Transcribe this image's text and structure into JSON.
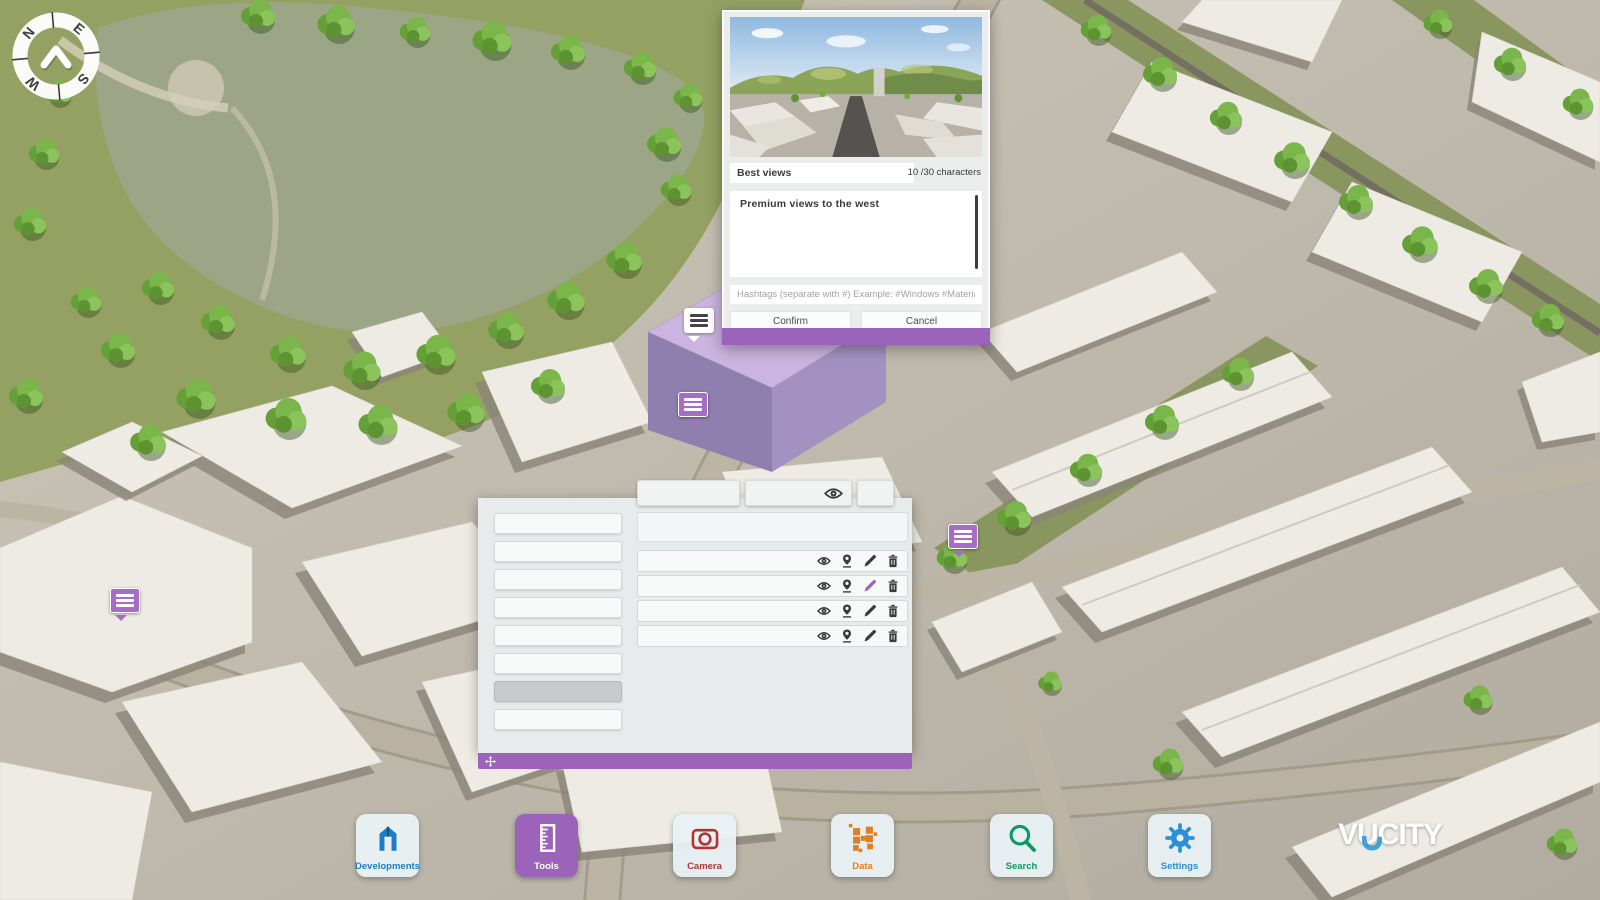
{
  "logo": {
    "text": "VUCITY"
  },
  "compass": {
    "letters": [
      "N",
      "E",
      "S",
      "W"
    ]
  },
  "map": {
    "markers": [
      {
        "id": "note-marker-1",
        "style": "white",
        "x": 684,
        "y": 308
      },
      {
        "id": "note-marker-2",
        "style": "purple",
        "x": 678,
        "y": 392
      },
      {
        "id": "note-marker-3",
        "style": "purple",
        "x": 948,
        "y": 524
      },
      {
        "id": "note-marker-4",
        "style": "purple",
        "x": 110,
        "y": 588
      }
    ],
    "selected_development_color": "#ccb4e0"
  },
  "annotation_dialog": {
    "title_value": "Best views",
    "char_counter": "10 /30 characters",
    "description_value": "Premium views to the west",
    "hashtags_placeholder": "Hashtags (separate with #) Example: #Windows #Material",
    "confirm_label": "Confirm",
    "cancel_label": "Cancel"
  },
  "tools_panel": {
    "header_buttons": [
      {
        "label": "",
        "icon": null
      },
      {
        "label": "",
        "icon": "eye-icon"
      },
      {
        "label": "",
        "icon": null
      }
    ],
    "left_buttons": {
      "count": 8,
      "selected_index": 6
    },
    "note_title_field_value": "",
    "note_rows": [
      {
        "icons": [
          "eye",
          "location-pin",
          "edit-pencil",
          "delete-trash"
        ],
        "edit_active": false
      },
      {
        "icons": [
          "eye",
          "location-pin",
          "edit-pencil",
          "delete-trash"
        ],
        "edit_active": true
      },
      {
        "icons": [
          "eye",
          "location-pin",
          "edit-pencil",
          "delete-trash"
        ],
        "edit_active": false
      },
      {
        "icons": [
          "eye",
          "location-pin",
          "edit-pencil",
          "delete-trash"
        ],
        "edit_active": false
      }
    ]
  },
  "toolbar": {
    "items": [
      {
        "id": "developments",
        "label": "Developments",
        "color": "#1d7dc4",
        "active": false
      },
      {
        "id": "tools",
        "label": "Tools",
        "color": "#9b63b9",
        "active": true
      },
      {
        "id": "camera",
        "label": "Camera",
        "color": "#b13434",
        "active": false
      },
      {
        "id": "data",
        "label": "Data",
        "color": "#e07f1f",
        "active": false
      },
      {
        "id": "search",
        "label": "Search",
        "color": "#0d9862",
        "active": false
      },
      {
        "id": "settings",
        "label": "Settings",
        "color": "#2b8fd8",
        "active": false
      }
    ]
  },
  "colors": {
    "accent_purple": "#9b63b9",
    "marker_purple": "#a76cc6",
    "panel_bg": "#e8ebeb",
    "dialog_bg": "#ebecec",
    "developments_blue": "#1d7dc4",
    "camera_red": "#b13434",
    "data_orange": "#e07f1f",
    "search_green": "#0d9862",
    "settings_blue": "#2b8fd8"
  }
}
